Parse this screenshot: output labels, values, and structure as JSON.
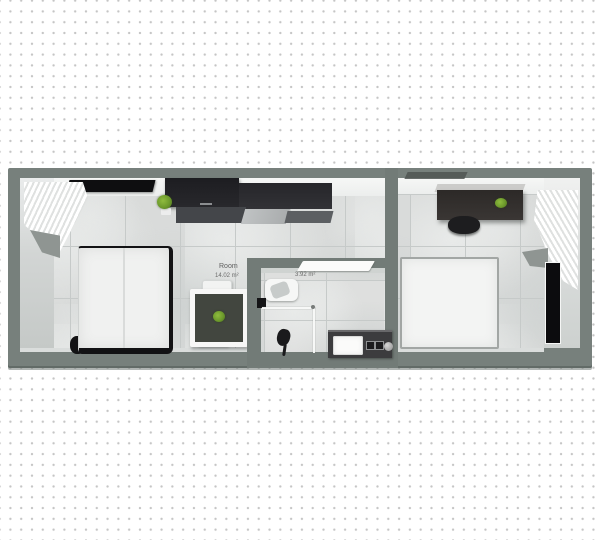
{
  "scene": {
    "type": "3d-floorplan-top-view",
    "canvas": "dotted-grid"
  },
  "labels": {
    "left_room_name": "Room",
    "left_room_area": "14.02 m²",
    "bathroom_area": "3.92 m²"
  },
  "rooms": [
    {
      "id": "room-left",
      "label": "Room",
      "area": "14.02 m²",
      "furniture": [
        "double-bed",
        "dining-table",
        "dining-chairs",
        "table-plant",
        "kitchen-upper-cabinets",
        "kitchen-counter",
        "wall-tv",
        "decor-plant",
        "window-curtain",
        "window-sill"
      ]
    },
    {
      "id": "bathroom",
      "area": "3.92 m²",
      "furniture": [
        "toilet",
        "shower-head",
        "shower-glass-screen",
        "vanity-washer-unit",
        "door-panel",
        "wall-hook"
      ]
    },
    {
      "id": "room-right",
      "furniture": [
        "double-bed",
        "desk",
        "desk-chair",
        "desk-plant",
        "radiator-panel",
        "window-curtain",
        "window-sill"
      ]
    }
  ],
  "colors": {
    "background": "#ffffff",
    "grid_dot": "#c5c5c5",
    "wall": "#77807c",
    "wall_inner_face": "#d3d6d5",
    "ceiling_face": "#f3f4f3",
    "floor_tile": "#d9dbda",
    "floor_grout": "#c6cac9",
    "furniture_dark": "#232327",
    "plant_green": "#7fae35",
    "label_text": "#5f5f5f"
  }
}
